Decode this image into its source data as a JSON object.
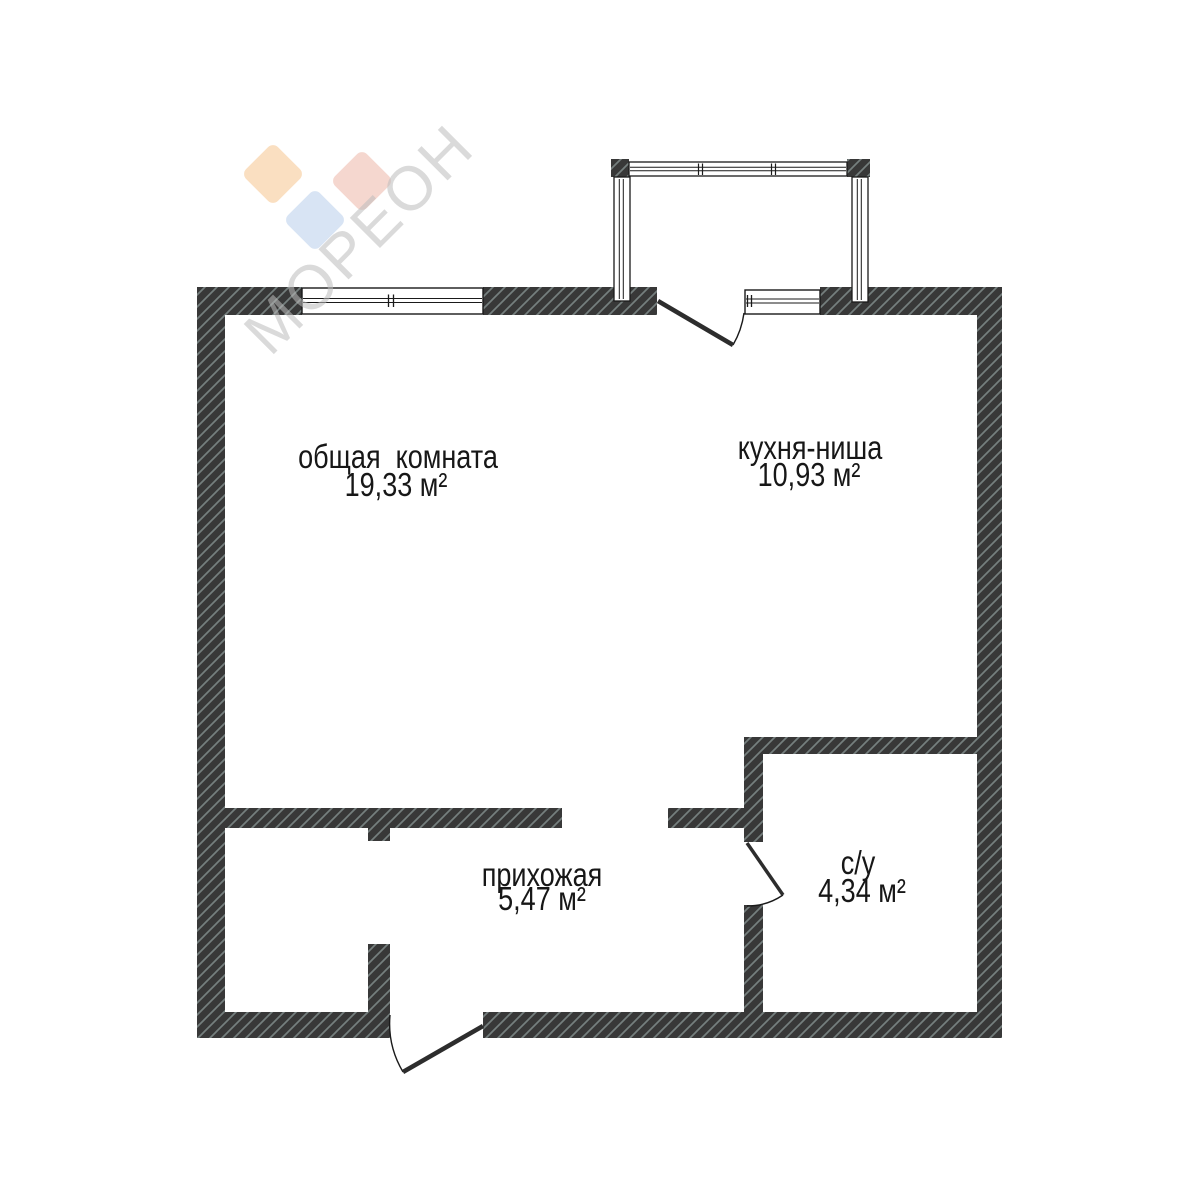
{
  "document": {
    "type": "apartment floor plan",
    "language": "ru"
  },
  "watermark": {
    "brand": "МОРЕОН",
    "diamond_colors": {
      "orange": "#F2A24E",
      "red": "#DE7961",
      "blue": "#86ABDE"
    }
  },
  "rooms": [
    {
      "id": "living",
      "name": "общая  комната",
      "area": "19,33 м²"
    },
    {
      "id": "kitchen",
      "name": "кухня-ниша",
      "area": "10,93 м²"
    },
    {
      "id": "hallway",
      "name": "прихожая",
      "area": "5,47 м²"
    },
    {
      "id": "bathroom",
      "name": "с/у",
      "area": "4,34 м²"
    }
  ],
  "colors": {
    "wall_fill": "#383838",
    "wall_hatch_line": "#757F7E",
    "outline": "#1A1A1A",
    "door_leaf": "#2D2D2D",
    "background": "#FFFFFF"
  }
}
